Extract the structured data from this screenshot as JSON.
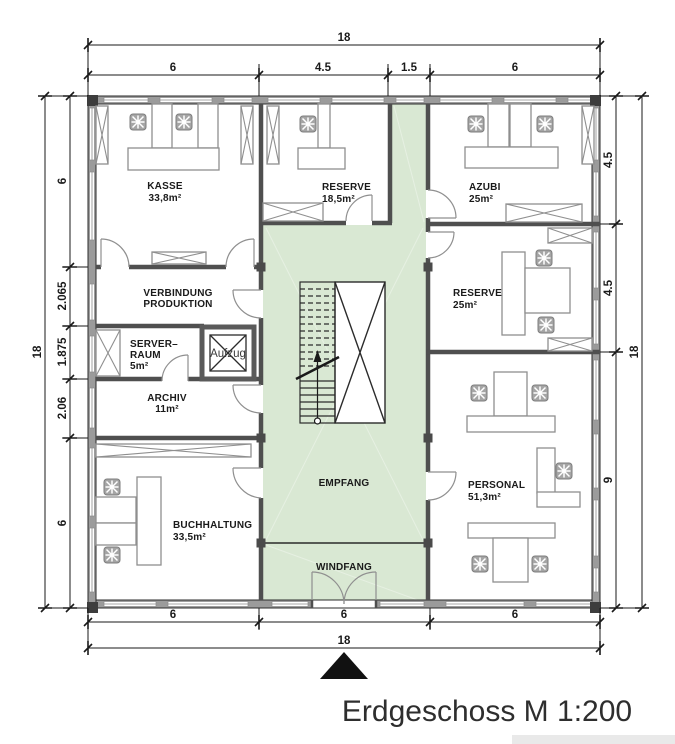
{
  "title": "Erdgeschoss M 1:200",
  "plan": {
    "rooms": {
      "kasse": {
        "name": "KASSE",
        "area": "33,8m²"
      },
      "reserve_top": {
        "name": "RESERVE",
        "area": "18,5m²"
      },
      "azubi": {
        "name": "AZUBI",
        "area": "25m²"
      },
      "verbindung": {
        "line1": "VERBINDUNG",
        "line2": "PRODUKTION"
      },
      "server": {
        "line1": "SERVER–",
        "line2": "RAUM",
        "area": "5m²"
      },
      "aufzug": {
        "name": "Aufzug"
      },
      "archiv": {
        "name": "ARCHIV",
        "area": "11m²"
      },
      "buchhaltung": {
        "name": "BUCHHALTUNG",
        "area": "33,5m²"
      },
      "reserve_mid": {
        "name": "RESERVE",
        "area": "25m²"
      },
      "personal": {
        "name": "PERSONAL",
        "area": "51,3m²"
      },
      "empfang": {
        "name": "EMPFANG"
      },
      "windfang": {
        "name": "WINDFANG"
      }
    },
    "dimensions": {
      "top": {
        "total": "18",
        "segments": [
          "6",
          "4.5",
          "1.5",
          "6"
        ]
      },
      "bottom": {
        "total": "18",
        "segments": [
          "6",
          "6",
          "6"
        ]
      },
      "left": {
        "total": "18",
        "segments": [
          "6",
          "2.065",
          "1.875",
          "2.06",
          "6"
        ]
      },
      "right": {
        "total": "18",
        "segments": [
          "4.5",
          "4.5",
          "9"
        ]
      }
    },
    "colors": {
      "zone_green": "#d9e8d3",
      "wall_gray": "#9b9b9b",
      "line_dark": "#2b2b2b"
    }
  }
}
